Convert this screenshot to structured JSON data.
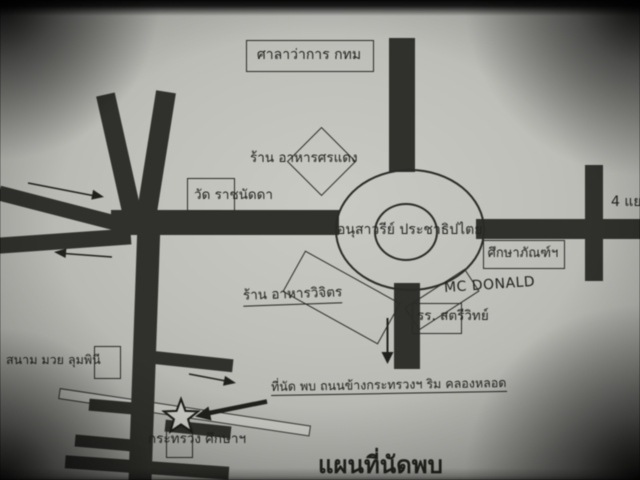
{
  "map": {
    "title": "แผนที่นัดพบ",
    "labels": {
      "city_hall": "ศาลาว่าการ กทม",
      "restaurant_sorndaeng": "ร้าน อาหารศรแดง",
      "wat_ratchanadda": "วัด ราชนัดดา",
      "democracy_monument": "อนุสาวรีย์ ประชาธิปไตย",
      "four_way_junction": "4 แยก",
      "suksapan": "ศึกษาภัณฑ์ฯ",
      "mcdonald": "MC DONALD",
      "satri_school": "รร. สตรีวิทย์",
      "restaurant_vijit": "ร้าน อาหารวิจิตร",
      "boxing_stadium": "สนาม มวย ลุมพินี",
      "meeting_point": "ที่นัด พบ ถนนข้างกระทรวงฯ ริม คลองหลอด",
      "ministry_education": "กระทรวง ศึกษาฯ"
    },
    "colors": {
      "paper": "#c0c0bb",
      "road": "#30302c",
      "ink": "#21211d"
    },
    "icons": {
      "star": "meeting-point-star",
      "arrows": [
        "arrow-east",
        "arrow-west",
        "arrow-south",
        "arrow-southeast",
        "meeting-pointer-arrow"
      ]
    }
  }
}
